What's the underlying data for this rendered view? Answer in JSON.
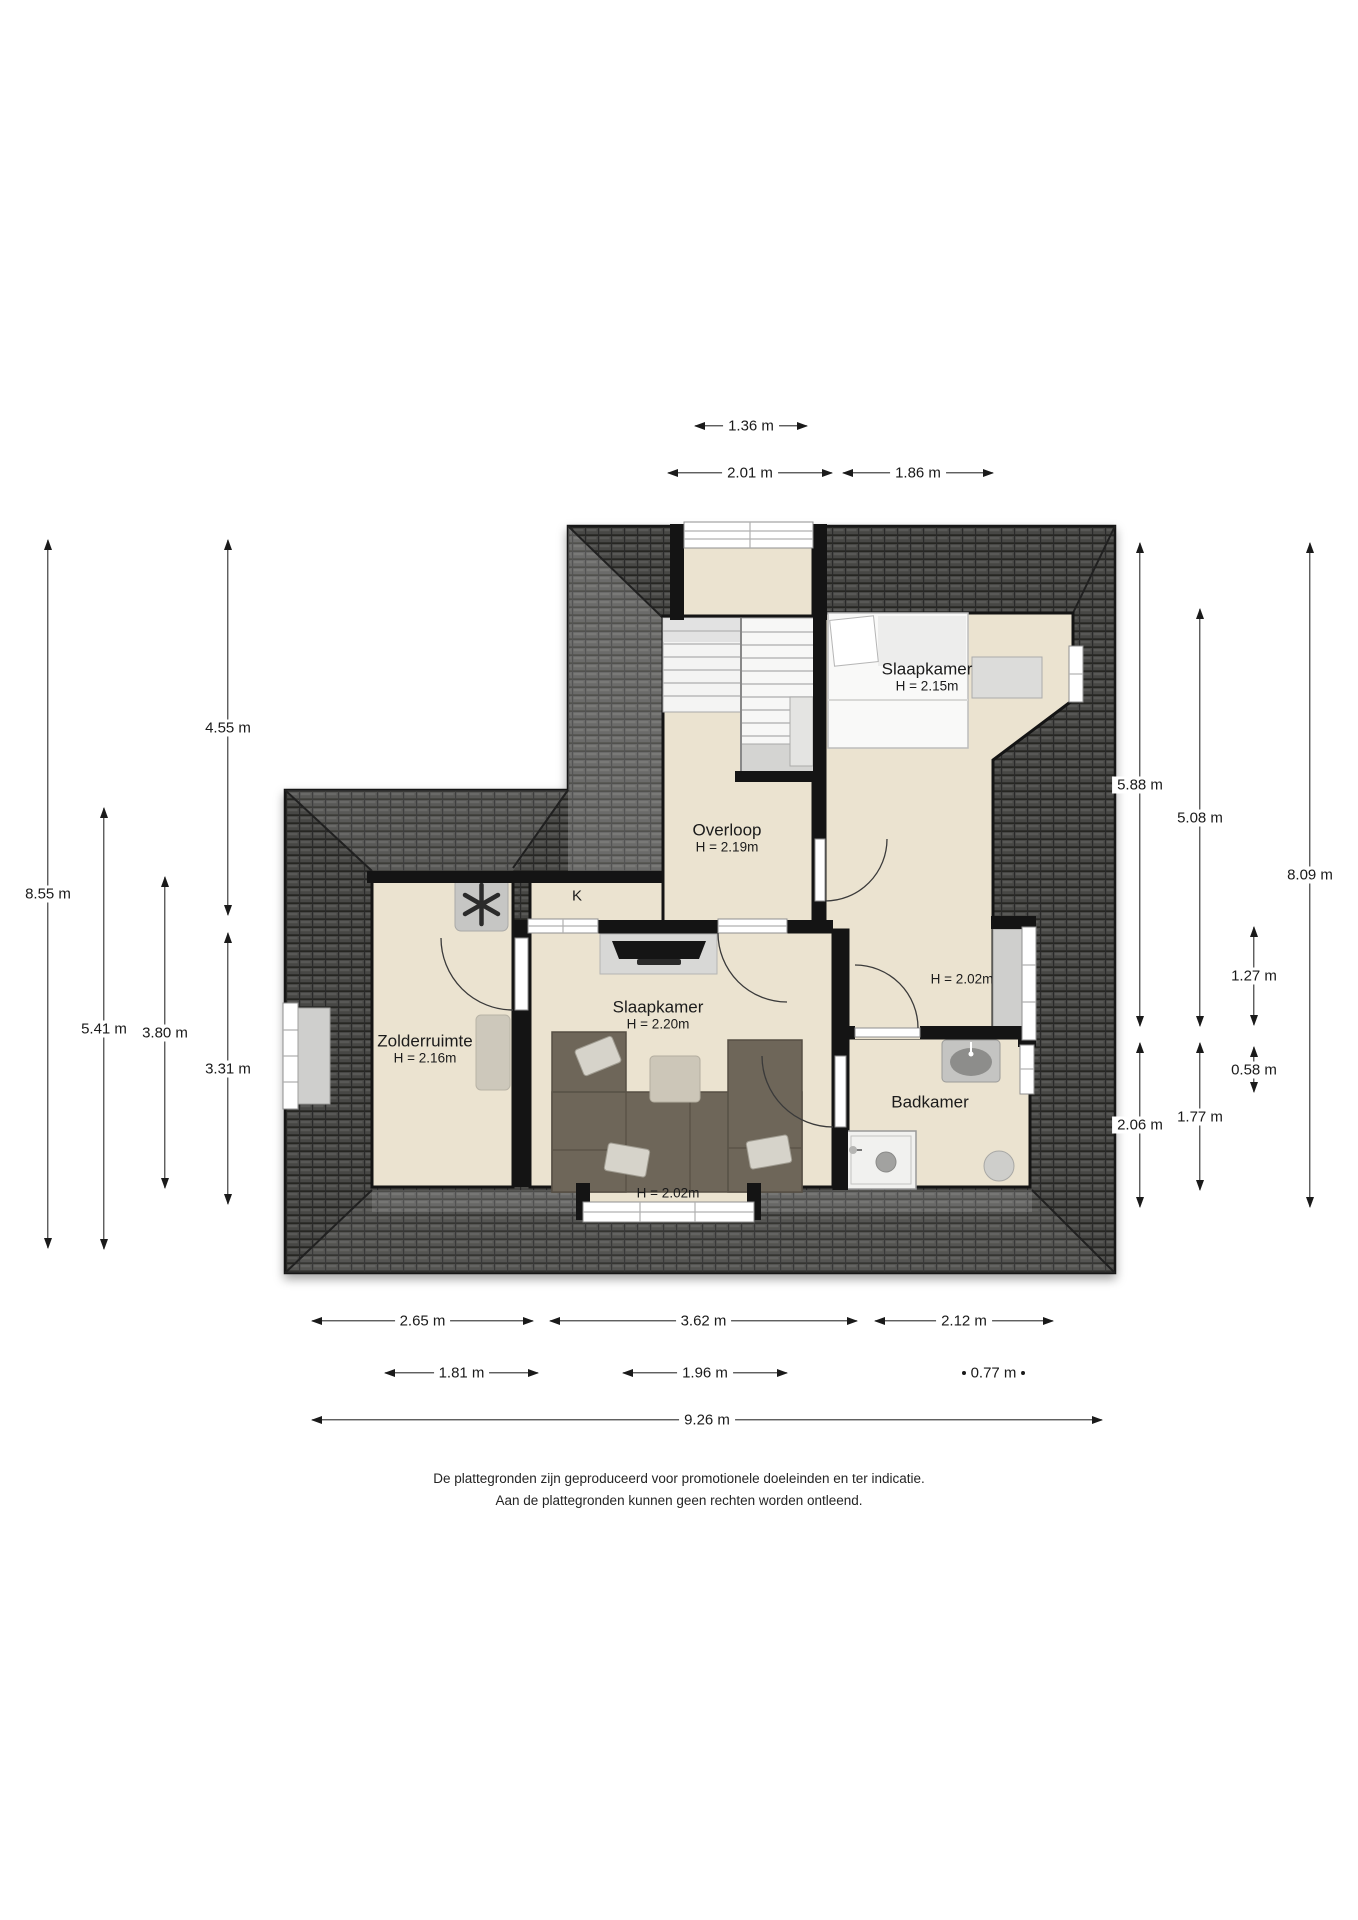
{
  "rooms": {
    "overloop": {
      "label": "Overloop",
      "height": "H = 2.19m"
    },
    "slaapkamer_boven": {
      "label": "Slaapkamer",
      "height": "H = 2.15m"
    },
    "zolderruimte": {
      "label": "Zolderruimte",
      "height": "H = 2.16m"
    },
    "slaapkamer_midden": {
      "label": "Slaapkamer",
      "height": "H = 2.20m"
    },
    "badkamer": {
      "label": "Badkamer"
    },
    "kast": {
      "label": "K"
    },
    "raamhoogte_rechts": {
      "label": "H = 2.02m"
    },
    "raamhoogte_onder": {
      "label": "H = 2.02m"
    }
  },
  "dimensions": {
    "top": [
      {
        "label": "1.36 m"
      },
      {
        "label": "2.01 m"
      },
      {
        "label": "1.86 m"
      }
    ],
    "left": [
      {
        "label": "8.55 m"
      },
      {
        "label": "5.41 m"
      },
      {
        "label": "3.80 m"
      },
      {
        "label": "4.55 m"
      },
      {
        "label": "3.31 m"
      }
    ],
    "right": [
      {
        "label": "5.88 m"
      },
      {
        "label": "5.08 m"
      },
      {
        "label": "8.09 m"
      },
      {
        "label": "1.27 m"
      },
      {
        "label": "0.58 m"
      },
      {
        "label": "2.06 m"
      },
      {
        "label": "1.77 m"
      }
    ],
    "bottom": [
      {
        "label": "2.65 m"
      },
      {
        "label": "3.62 m"
      },
      {
        "label": "2.12 m"
      },
      {
        "label": "1.81 m"
      },
      {
        "label": "1.96 m"
      },
      {
        "label": "0.77 m"
      },
      {
        "label": "9.26 m"
      }
    ]
  },
  "footer": {
    "line1": "De plattegronden zijn geproduceerd voor promotionele doeleinden en ter indicatie.",
    "line2": "Aan de plattegronden kunnen geen rechten worden ontleend."
  },
  "colors": {
    "roof": "#474745",
    "floor": "#ebe3d0",
    "wall": "#141414",
    "dimension_text": "#1a1a1a"
  }
}
